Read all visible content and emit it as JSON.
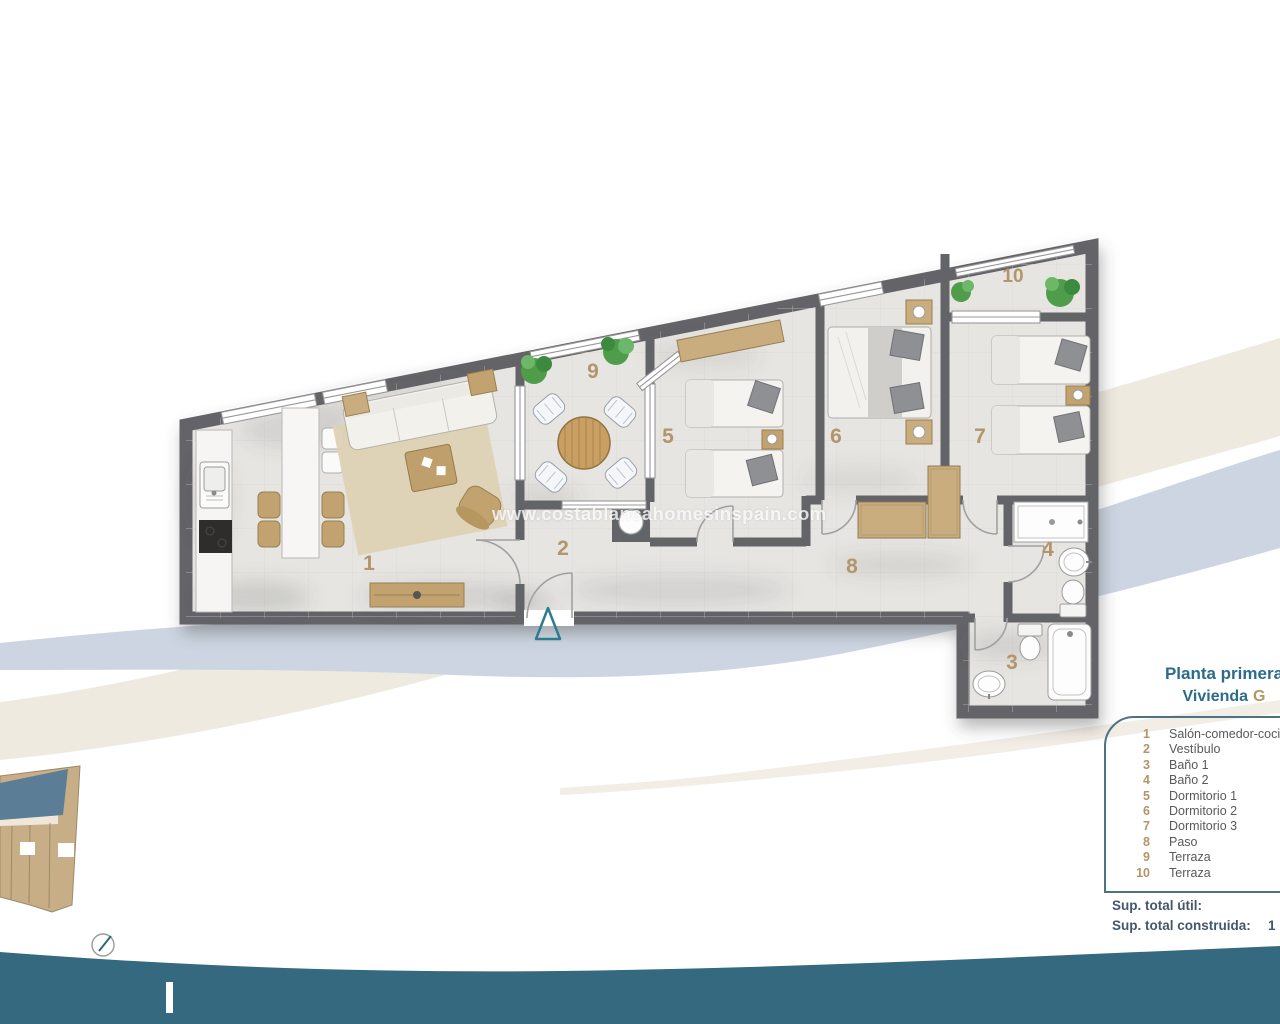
{
  "watermark": "www.costablancahomesinspain.com",
  "panel": {
    "title_line1": "Planta primera",
    "title_line2_prefix": "Vivienda",
    "title_line2_unit": "G",
    "totals": {
      "util_label": "Sup. total útil:",
      "construida_label": "Sup. total construida:",
      "construida_value_visible": "1"
    }
  },
  "rooms": [
    {
      "number": "1",
      "label": "Salón-comedor-cocina"
    },
    {
      "number": "2",
      "label": "Vestíbulo"
    },
    {
      "number": "3",
      "label": "Baño 1"
    },
    {
      "number": "4",
      "label": "Baño 2"
    },
    {
      "number": "5",
      "label": "Dormitorio 1"
    },
    {
      "number": "6",
      "label": "Dormitorio 2"
    },
    {
      "number": "7",
      "label": "Dormitorio 3"
    },
    {
      "number": "8",
      "label": "Paso"
    },
    {
      "number": "9",
      "label": "Terraza"
    },
    {
      "number": "10",
      "label": "Terraza"
    }
  ],
  "colors": {
    "title_teal": "#2b6c8a",
    "accent_tan": "#b2956a",
    "wave_teal": "#34697f",
    "wall_gray": "#636467",
    "floor_gray": "#e7e5e1",
    "swoosh_blue": "#ccd5e1",
    "swoosh_beige": "#ece6db",
    "site_unit_blue": "#5b7d96",
    "site_building_tan": "#c8ae86"
  }
}
